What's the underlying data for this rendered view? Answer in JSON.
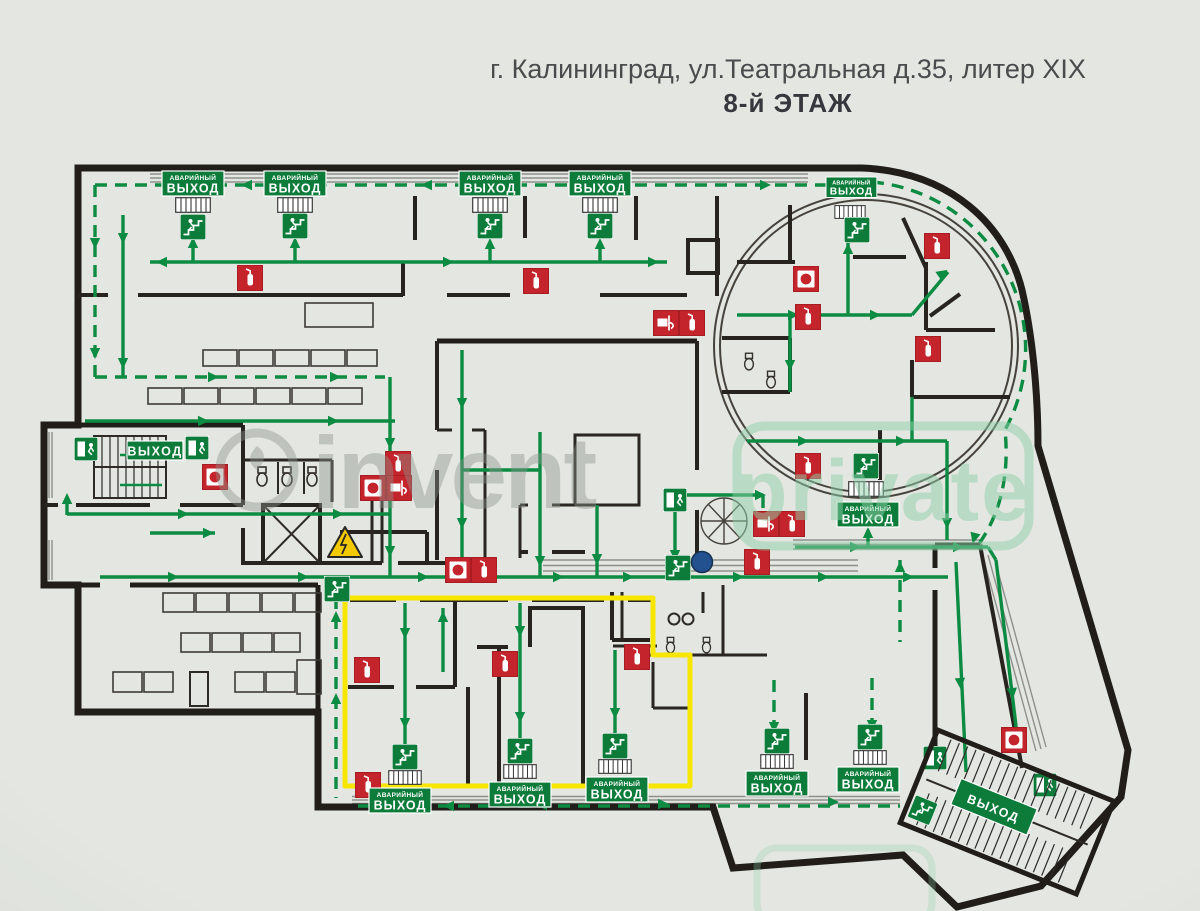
{
  "title": {
    "line1": "г. Калининград, ул.Театральная д.35, литер XIX",
    "line2": "8-й ЭТАЖ"
  },
  "signs": {
    "emergency_line1": "АВАРИЙНЫЙ",
    "emergency_line2": "ВЫХОД",
    "exit_label": "ВЫХОД"
  },
  "watermarks": {
    "left": "invent",
    "right": "private"
  },
  "colors": {
    "background": "#e3e6e1",
    "wall": "#211e1a",
    "route_green": "#0c8b42",
    "sign_green": "#0d7c3a",
    "equipment_red": "#c4242b",
    "highlight_yellow": "#f7e600",
    "hazard_yellow": "#f3c900",
    "you_are_here_blue": "#23508e",
    "watermark_gray": "#8e948e",
    "watermark_green": "#8fd0a8"
  }
}
